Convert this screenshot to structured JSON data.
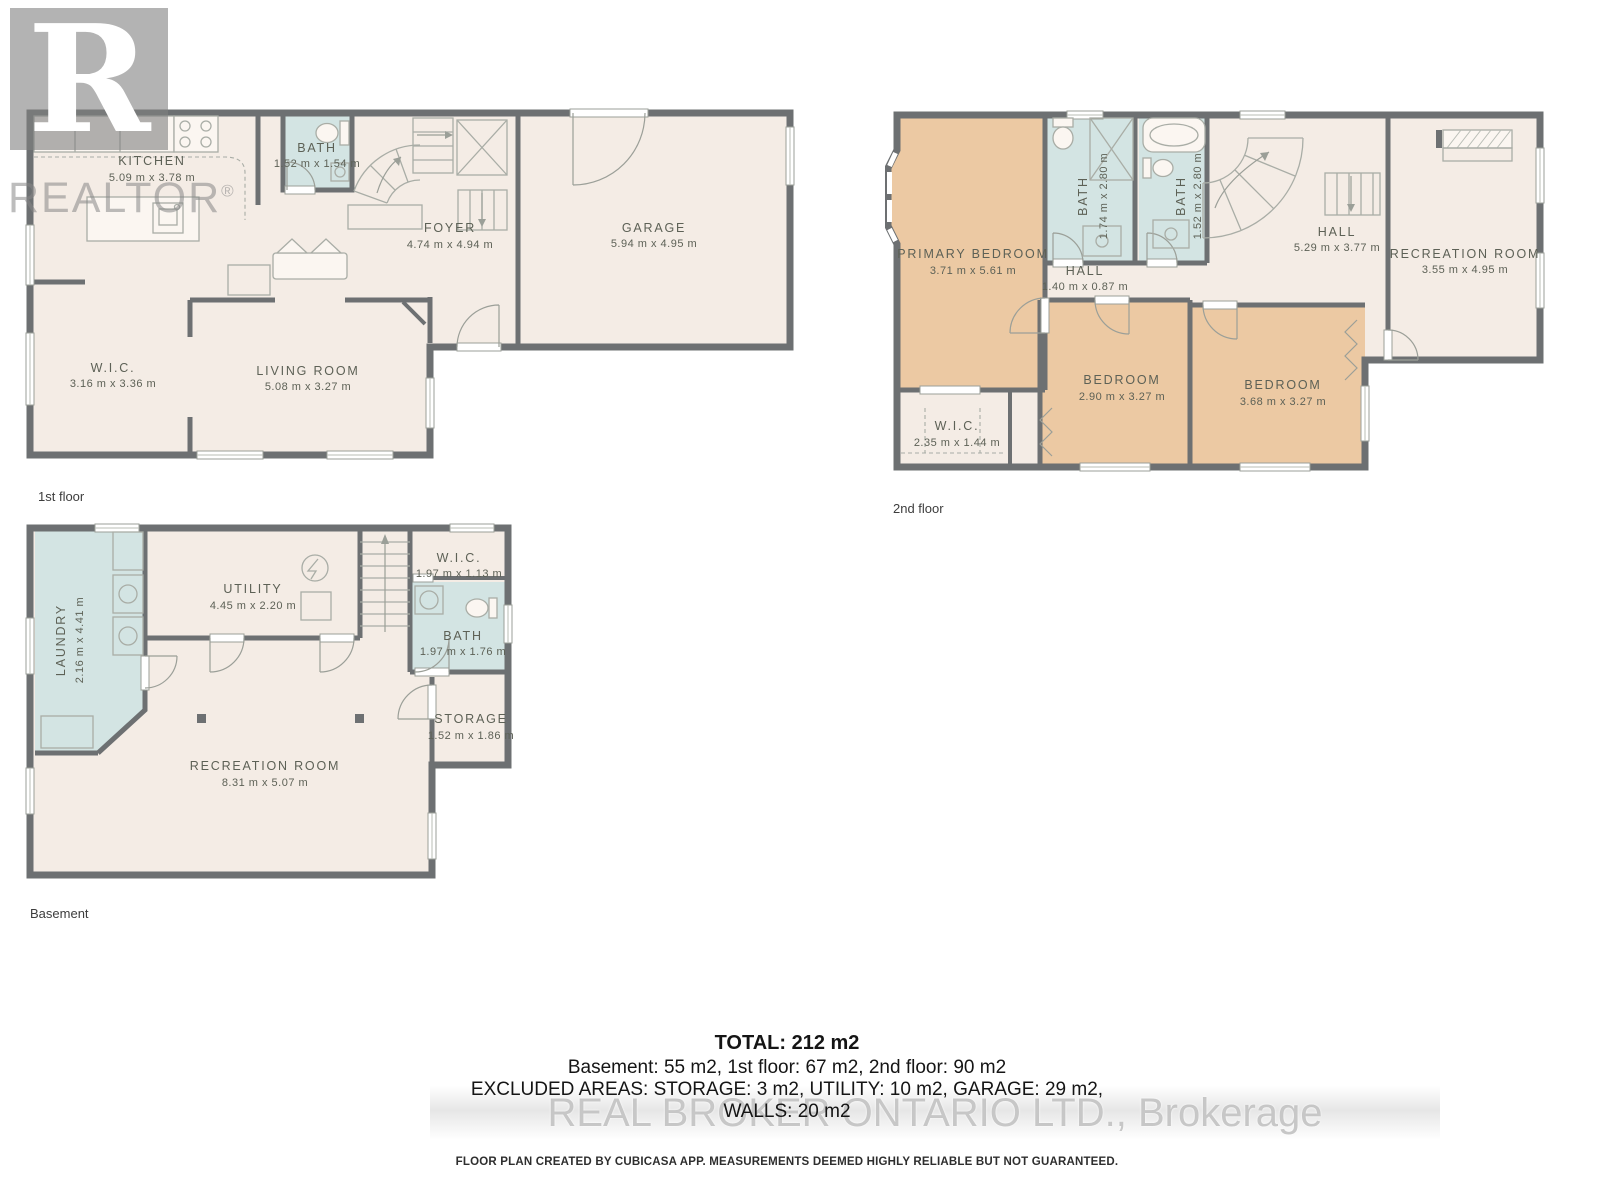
{
  "branding": {
    "realtor_logo_letter": "R",
    "realtor_text": "REALTOR",
    "registered_mark": "®",
    "bottom_watermark": "REAL BROKER ONTARIO LTD.,  Brokerage"
  },
  "floors": {
    "floor1": {
      "label": "1st floor",
      "rooms": {
        "kitchen": {
          "name": "KITCHEN",
          "dims": "5.09 m x 3.78 m"
        },
        "bath": {
          "name": "BATH",
          "dims": "1.52 m x 1.54 m"
        },
        "foyer": {
          "name": "FOYER",
          "dims": "4.74 m x 4.94 m"
        },
        "garage": {
          "name": "GARAGE",
          "dims": "5.94 m x 4.95 m"
        },
        "wic": {
          "name": "W.I.C.",
          "dims": "3.16 m x 3.36 m"
        },
        "living": {
          "name": "LIVING ROOM",
          "dims": "5.08 m x 3.27 m"
        }
      }
    },
    "floor2": {
      "label": "2nd floor",
      "rooms": {
        "primary": {
          "name": "PRIMARY BEDROOM",
          "dims": "3.71 m x 5.61 m"
        },
        "bath_a": {
          "name": "BATH",
          "dims": "1.74 m x 2.80 m"
        },
        "bath_b": {
          "name": "BATH",
          "dims": "1.52 m x 2.80 m"
        },
        "hall_small": {
          "name": "HALL",
          "dims": "1.40 m x 0.87 m"
        },
        "hall": {
          "name": "HALL",
          "dims": "5.29 m x 3.77 m"
        },
        "recreation": {
          "name": "RECREATION ROOM",
          "dims": "3.55 m x 4.95 m"
        },
        "bedroom_a": {
          "name": "BEDROOM",
          "dims": "2.90 m x 3.27 m"
        },
        "bedroom_b": {
          "name": "BEDROOM",
          "dims": "3.68 m x 3.27 m"
        },
        "wic": {
          "name": "W.I.C.",
          "dims": "2.35 m x 1.44 m"
        }
      }
    },
    "basement": {
      "label": "Basement",
      "rooms": {
        "laundry": {
          "name": "LAUNDRY",
          "dims": "2.16 m x 4.41 m"
        },
        "utility": {
          "name": "UTILITY",
          "dims": "4.45 m x 2.20 m"
        },
        "wic": {
          "name": "W.I.C.",
          "dims": "1.97 m x 1.13 m"
        },
        "bath": {
          "name": "BATH",
          "dims": "1.97 m x 1.76 m"
        },
        "storage": {
          "name": "STORAGE",
          "dims": "1.52 m x 1.86 m"
        },
        "recreation": {
          "name": "RECREATION ROOM",
          "dims": "8.31 m x 5.07 m"
        }
      }
    }
  },
  "summary": {
    "total": "TOTAL: 212 m2",
    "per_floor": "Basement: 55 m2, 1st floor: 67 m2, 2nd floor: 90 m2",
    "excluded": "EXCLUDED AREAS: STORAGE: 3 m2, UTILITY: 10 m2, GARAGE: 29 m2,",
    "walls": "WALLS: 20 m2",
    "disclaimer": "FLOOR PLAN CREATED BY CUBICASA APP. MEASUREMENTS DEEMED HIGHLY RELIABLE BUT NOT GUARANTEED."
  },
  "colors": {
    "wall": "#6d7072",
    "floor_fill": "#f4ece5",
    "bedroom_fill": "#ecc9a3",
    "wet_room_fill": "#d3e4e3",
    "label_text": "#5d6156"
  }
}
